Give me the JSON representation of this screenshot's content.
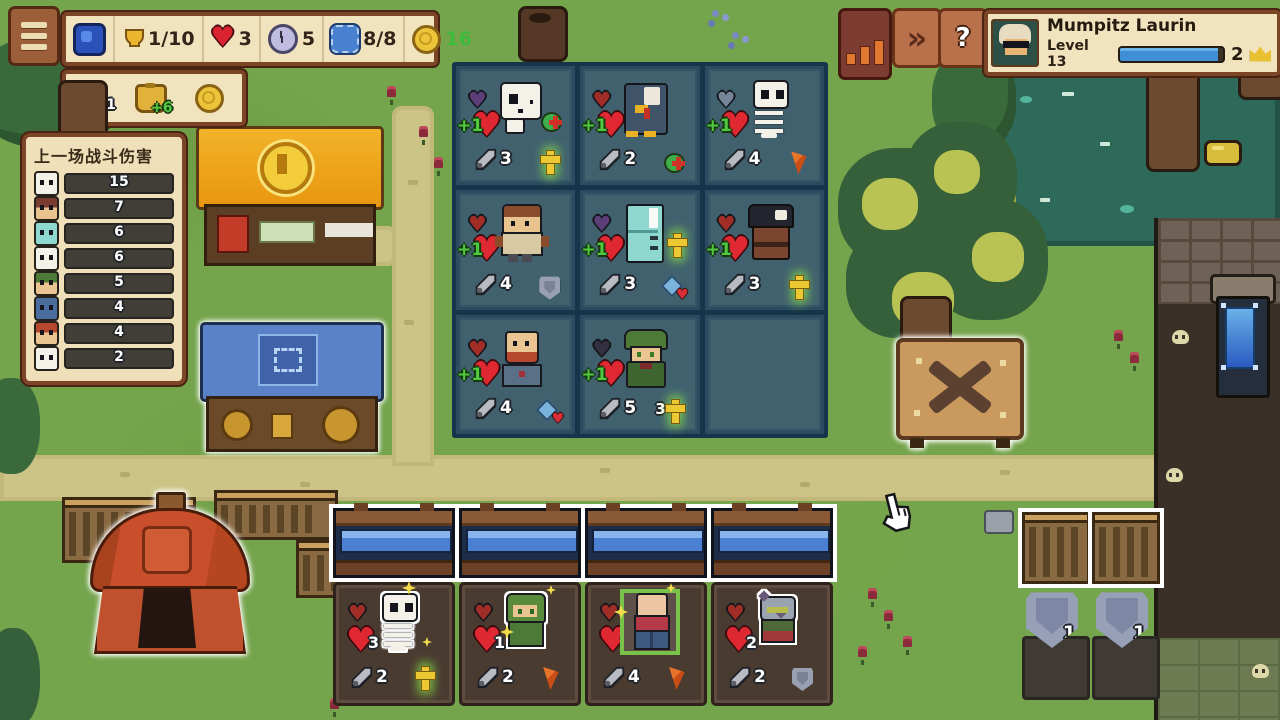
{
  "hud": {
    "resources": {
      "trophy": "1/10",
      "lives": "3",
      "round_timer": "5",
      "capacity": "8/8",
      "gold": "16"
    },
    "economy": {
      "clover": "1",
      "income_bonus": "+6"
    },
    "fast_forward_label": "»",
    "help_label": "?",
    "player": {
      "name": "Mumpitz Laurin",
      "level": "Level 13",
      "xp_pct": 95,
      "crowns": "2"
    }
  },
  "damage_panel": {
    "title": "上一场战斗伤害",
    "max": 15,
    "rows": [
      {
        "unit": "skull",
        "value": "15",
        "pct": 100
      },
      {
        "unit": "bandit",
        "value": "7",
        "pct": 48
      },
      {
        "unit": "fridge",
        "value": "6",
        "pct": 41
      },
      {
        "unit": "skeleton",
        "value": "6",
        "pct": 41
      },
      {
        "unit": "elf",
        "value": "5",
        "pct": 35
      },
      {
        "unit": "blue-robot",
        "value": "4",
        "pct": 28
      },
      {
        "unit": "redhead",
        "value": "4",
        "pct": 28
      },
      {
        "unit": "skull",
        "value": "2",
        "pct": 15
      }
    ]
  },
  "board": {
    "cells": [
      {
        "unit": "skull-ghost",
        "badge": "purple",
        "heart_icon": "♥",
        "badge_icon": "♥",
        "buff": "+1",
        "attack": "3",
        "item_mid": "heal-potion",
        "item_br": "holy-cross"
      },
      {
        "unit": "penguin",
        "badge": "red",
        "heart_icon": "♥",
        "badge_icon": "♥",
        "buff": "+1",
        "attack": "2",
        "item_br": "heal-potion"
      },
      {
        "unit": "skeleton",
        "badge": "slate",
        "heart_icon": "♥",
        "badge_icon": "♥",
        "buff": "+1",
        "attack": "4",
        "item_br": "carrot"
      },
      {
        "unit": "warrior",
        "badge": "red",
        "heart_icon": "♥",
        "badge_icon": "♥",
        "buff": "+1",
        "attack": "4",
        "item_br": "shield"
      },
      {
        "unit": "fridge",
        "badge": "purple",
        "heart_icon": "♥",
        "badge_icon": "♥",
        "buff": "+1",
        "attack": "3",
        "item_mid": "holy-cross",
        "item_br": "ice-heart"
      },
      {
        "unit": "pirate",
        "badge": "red",
        "heart_icon": "♥",
        "badge_icon": "♥",
        "buff": "+1",
        "attack": "3",
        "item_br": "holy-cross"
      },
      {
        "unit": "dwarf",
        "badge": "red",
        "heart_icon": "♥",
        "badge_icon": "♥",
        "buff": "+1",
        "attack": "4",
        "item_br": "ice-heart"
      },
      {
        "unit": "elf-monk",
        "badge": "dark",
        "heart_icon": "♥",
        "badge_icon": "♥",
        "buff": "+1",
        "attack": "5",
        "item_br": "holy-cross",
        "item_br_count": "3"
      },
      {}
    ]
  },
  "shop": {
    "slots": [
      {
        "unit": "skeleton",
        "badge": "red",
        "heart_icon": "♥",
        "badge_icon": "♥",
        "hp": "3",
        "attack": "2",
        "item": "holy-cross"
      },
      {
        "unit": "elf-girl",
        "badge": "red",
        "heart_icon": "♥",
        "badge_icon": "♥",
        "hp": "1",
        "attack": "2",
        "item": "carrot"
      },
      {
        "unit": "brawler",
        "badge": "red",
        "heart_icon": "♥",
        "badge_icon": "♥",
        "hp": "2",
        "attack": "4",
        "item": "carrot"
      },
      {
        "unit": "cat-knight",
        "badge": "red",
        "heart_icon": "♥",
        "badge_icon": "♥",
        "hp": "2",
        "attack": "2",
        "item": "shield"
      }
    ]
  },
  "item_stalls": {
    "shields": [
      {
        "count": "1"
      },
      {
        "count": "1"
      }
    ]
  }
}
